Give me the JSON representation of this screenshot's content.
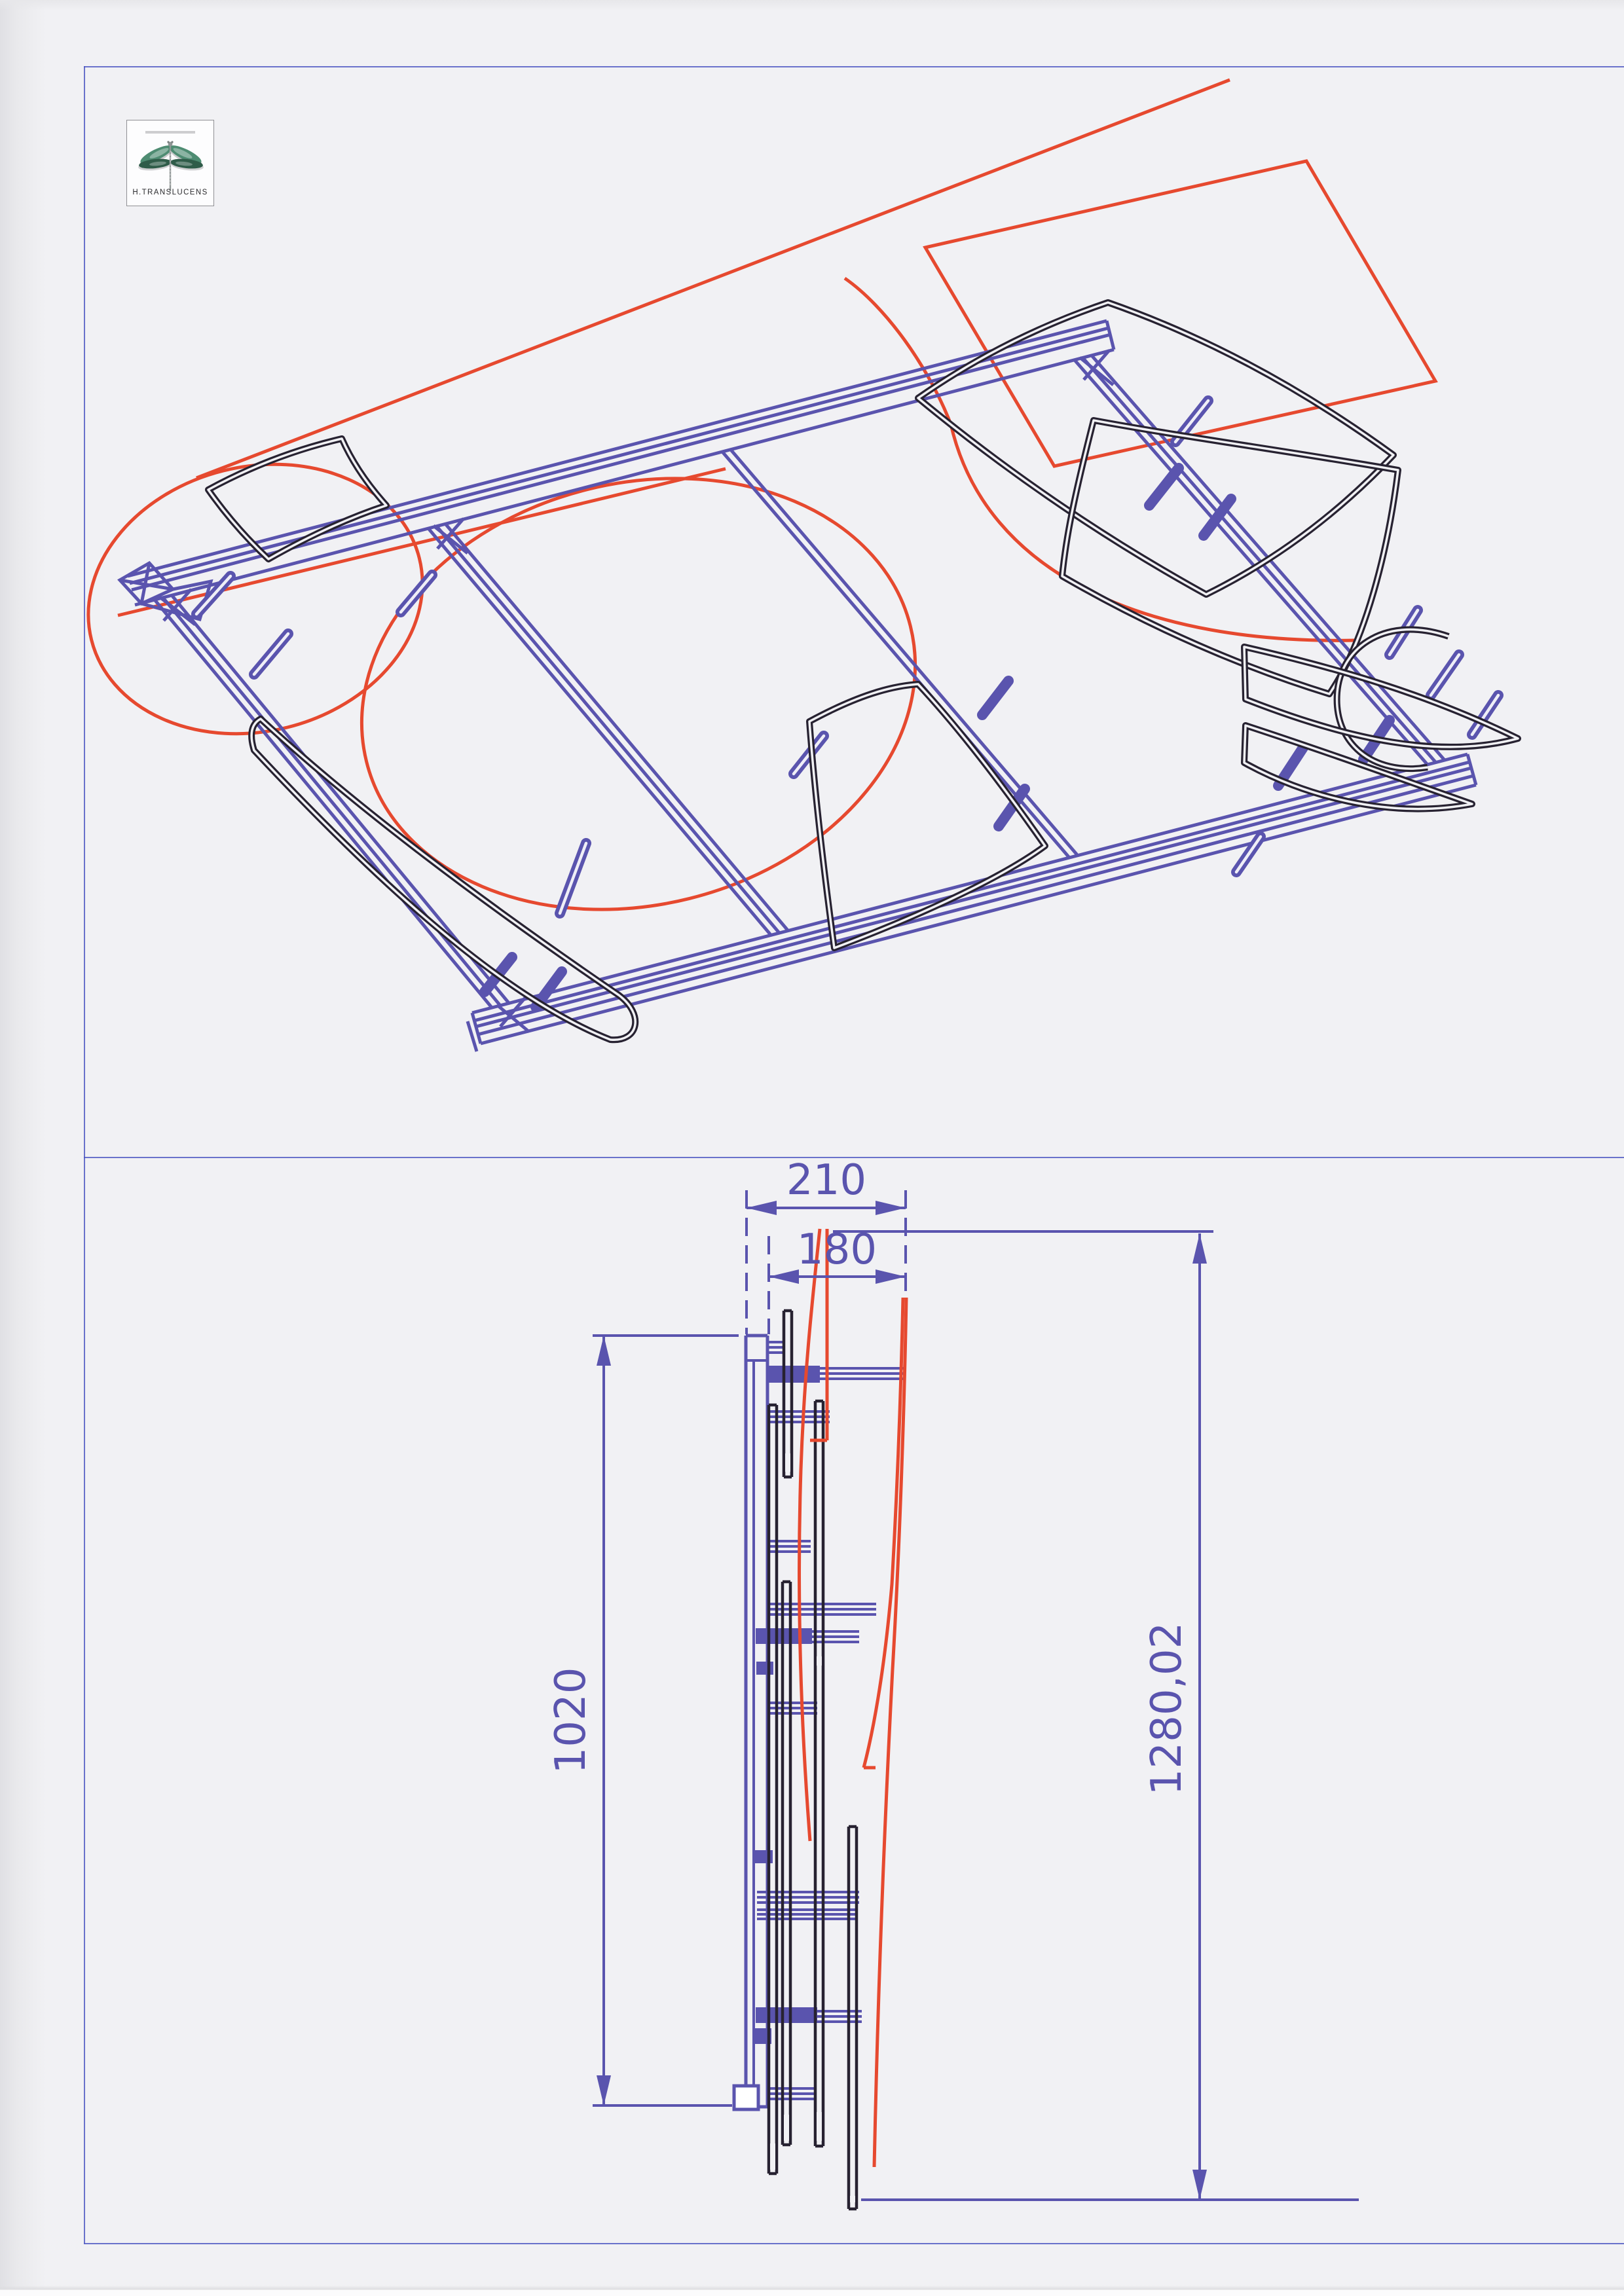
{
  "logo": {
    "brand": "H.TRANSLUCENS",
    "icon": "dragonfly-icon"
  },
  "dimensions": {
    "top_width": "210",
    "inner_width": "180",
    "left_height": "1020",
    "overall_height": "1280,02"
  },
  "colors": {
    "paper": "#f1f1f4",
    "frame_blue": "#5a54ae",
    "construction_red": "#e6492f",
    "profile_black": "#272231",
    "border_blue": "#4853c0",
    "wing_teal": "#4e8c72",
    "wing_teal_dark": "#2f5c49",
    "body_gray": "#8f9595"
  }
}
